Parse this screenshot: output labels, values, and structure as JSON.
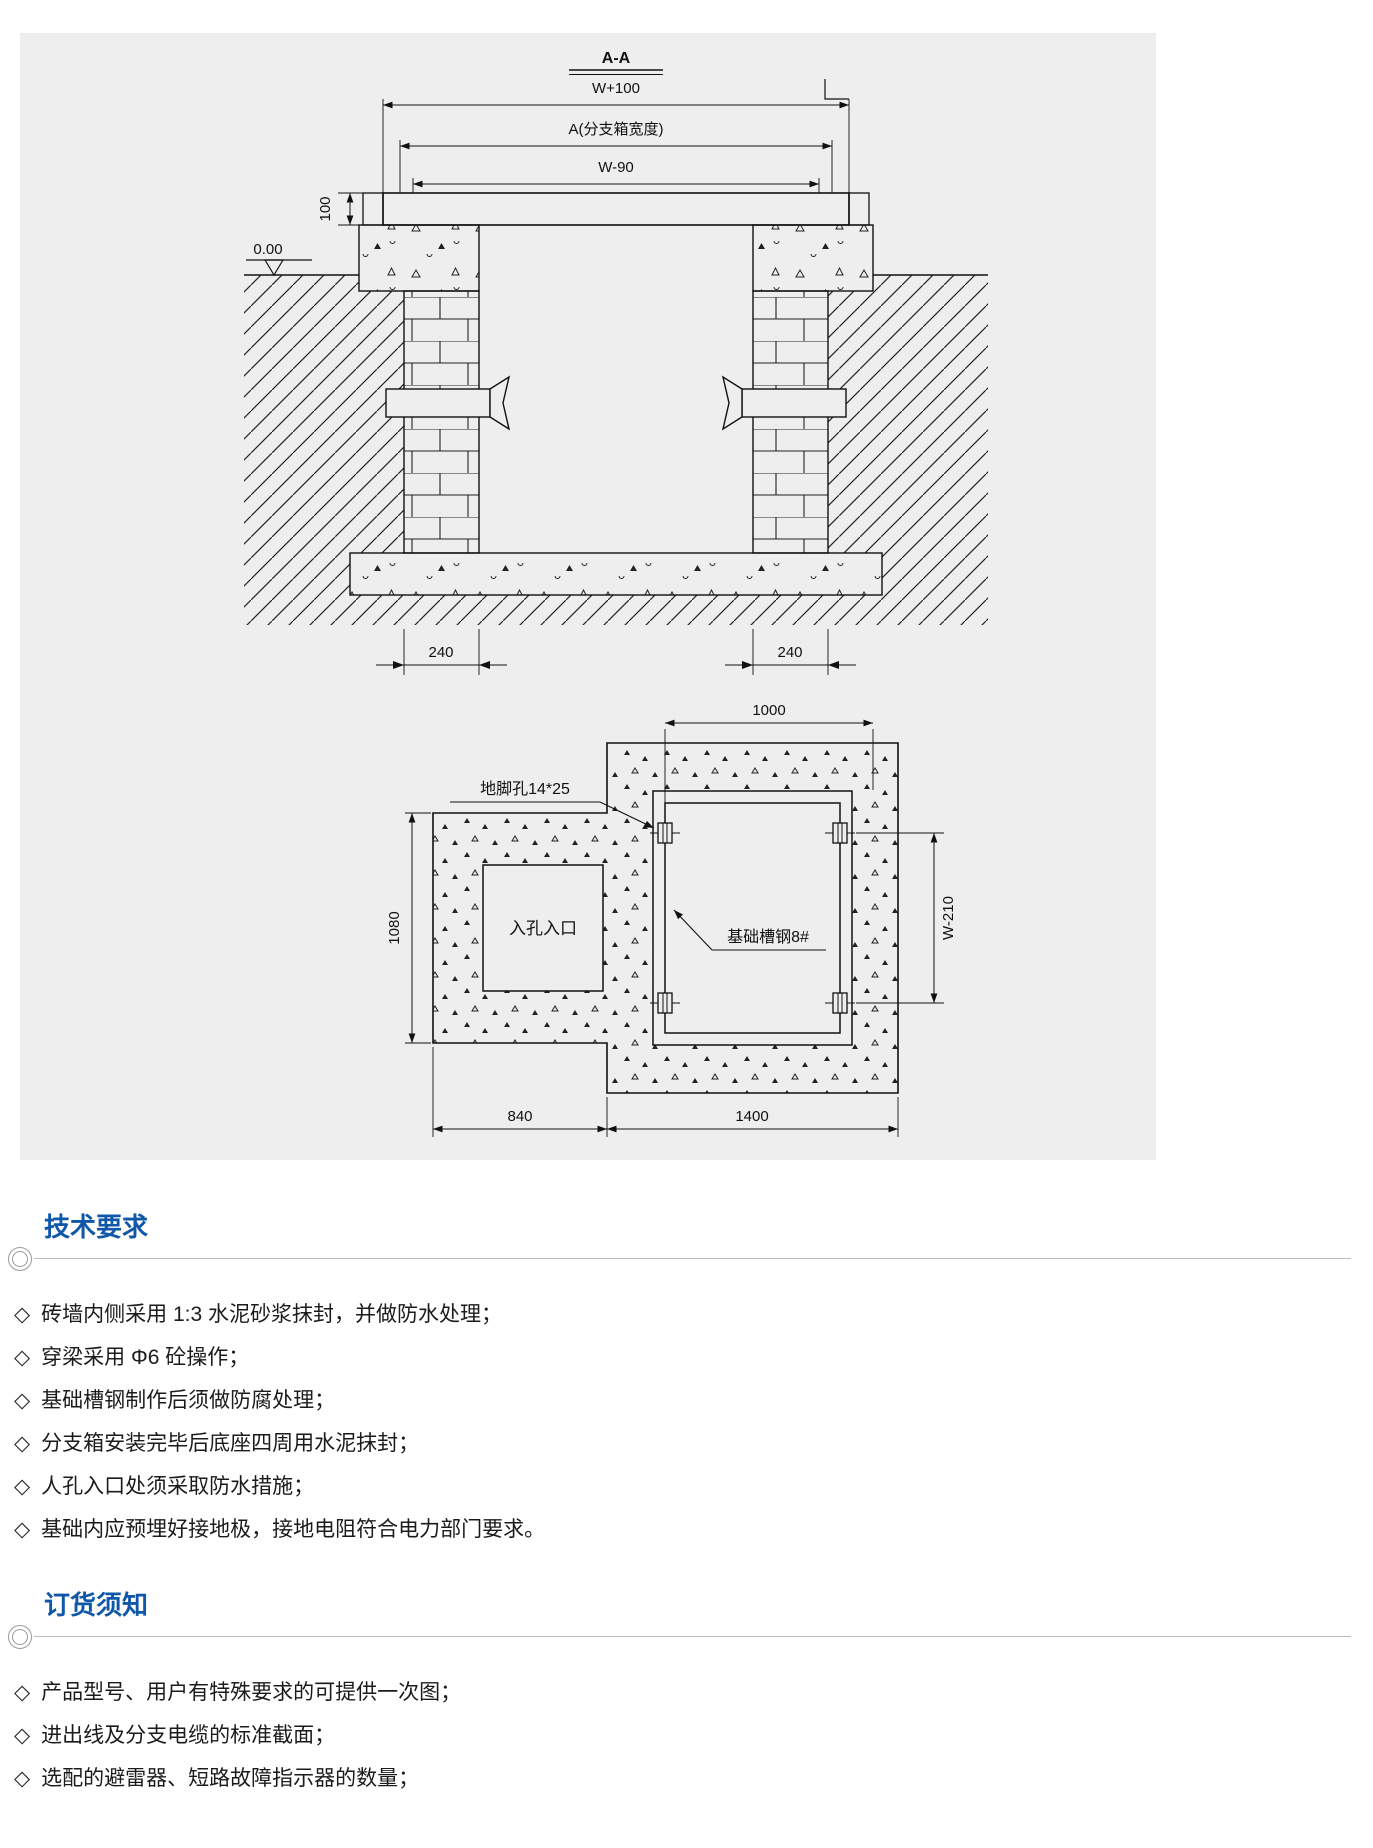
{
  "bullet": "◇",
  "colors": {
    "heading_blue": "#0f57a8",
    "panel_bg": "#eeeeef",
    "line": "#1a1a1a"
  },
  "drawing": {
    "section": {
      "title": "A-A",
      "dim_w100": "W+100",
      "dim_a": "A(分支箱宽度)",
      "dim_w90": "W-90",
      "dim_100": "100",
      "level": "0.00",
      "dim_240_left": "240",
      "dim_240_right": "240"
    },
    "plan": {
      "dim_1000": "1000",
      "anchor_label": "地脚孔14*25",
      "channel_label": "基础槽钢8#",
      "manhole_label": "入孔入口",
      "dim_1080": "1080",
      "dim_w210": "W-210",
      "dim_840": "840",
      "dim_1400": "1400"
    }
  },
  "sections": [
    {
      "heading": "技术要求",
      "items": [
        "砖墙内侧采用 1:3 水泥砂浆抹封，并做防水处理；",
        "穿梁采用 Φ6 砼操作；",
        "基础槽钢制作后须做防腐处理；",
        "分支箱安装完毕后底座四周用水泥抹封；",
        "人孔入口处须采取防水措施；",
        "基础内应预埋好接地极，接地电阻符合电力部门要求。"
      ]
    },
    {
      "heading": "订货须知",
      "items": [
        "产品型号、用户有特殊要求的可提供一次图；",
        "进出线及分支电缆的标准截面；",
        "选配的避雷器、短路故障指示器的数量；"
      ]
    }
  ]
}
